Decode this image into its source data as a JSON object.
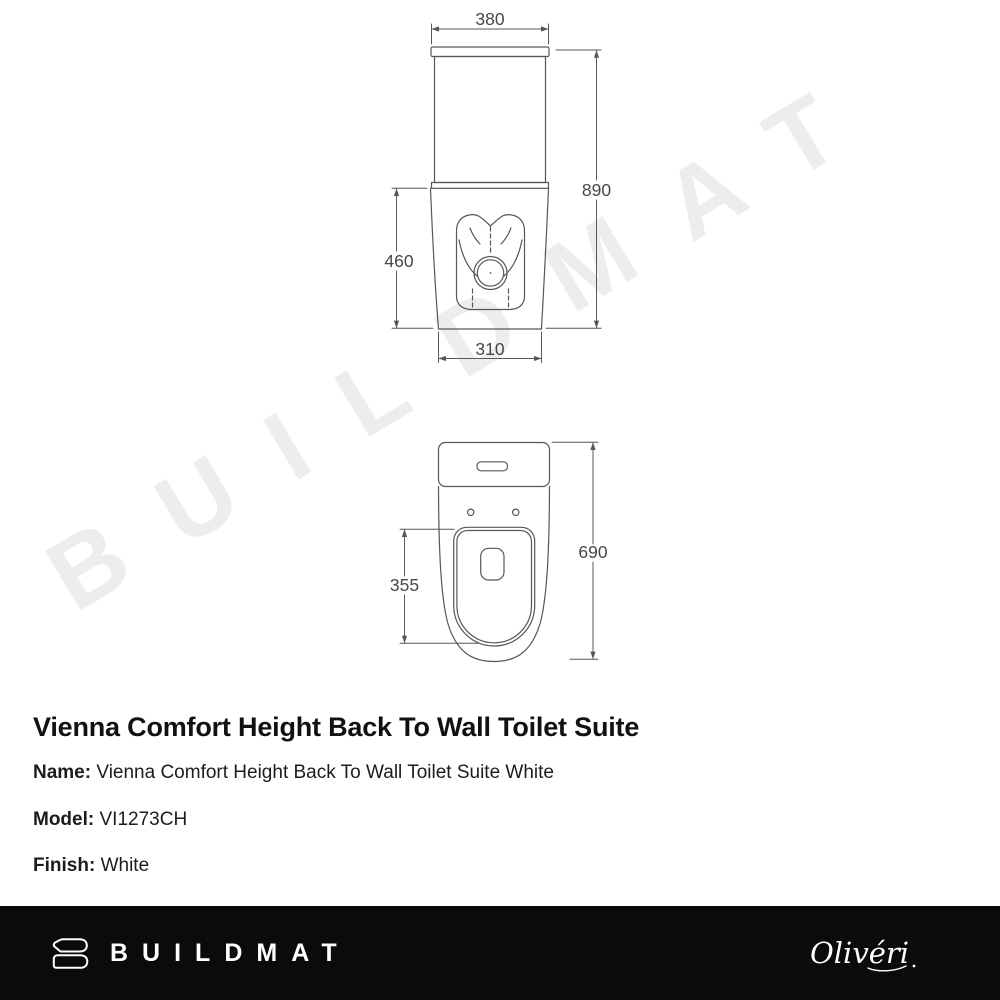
{
  "watermark": {
    "text": "BUILDMAT",
    "color": "#ededed"
  },
  "diagram": {
    "front_view": {
      "dim_width_top": "380",
      "dim_height_total": "890",
      "dim_height_pan": "460",
      "dim_width_base": "310"
    },
    "plan_view": {
      "dim_depth_total": "690",
      "dim_seat_length": "355"
    }
  },
  "product": {
    "title": "Vienna Comfort Height Back To Wall Toilet Suite",
    "specs": [
      {
        "label": "Name:",
        "value": "Vienna Comfort Height Back To Wall Toilet Suite White"
      },
      {
        "label": "Model:",
        "value": "VI1273CH"
      },
      {
        "label": "Finish:",
        "value": "White"
      }
    ]
  },
  "footer": {
    "brand": "BUILDMAT",
    "partner": "Olivéri",
    "background": "#0b0b0b",
    "text_color": "#ffffff"
  },
  "colors": {
    "drawing_line": "#57575a",
    "dim_text": "#474747",
    "title_text": "#111111"
  }
}
